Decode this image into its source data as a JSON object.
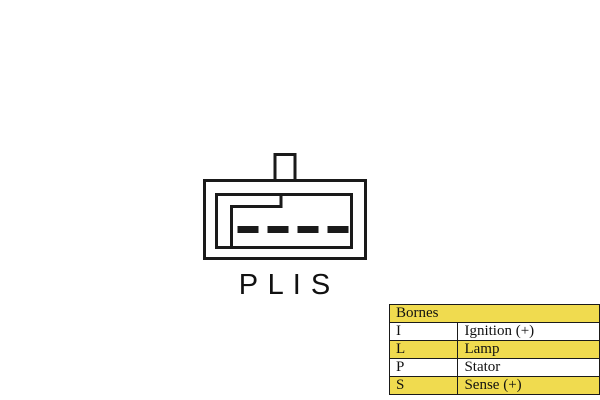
{
  "diagram": {
    "pin_labels": "P L I S",
    "line_color": "#1a1a1a"
  },
  "table": {
    "header": "Bornes",
    "highlight_color": "#F0DB4F",
    "rows": [
      {
        "terminal": "I",
        "function": "Ignition (+)",
        "highlighted": false
      },
      {
        "terminal": "L",
        "function": "Lamp",
        "highlighted": true
      },
      {
        "terminal": "P",
        "function": "Stator",
        "highlighted": false
      },
      {
        "terminal": "S",
        "function": "Sense (+)",
        "highlighted": true
      }
    ]
  }
}
